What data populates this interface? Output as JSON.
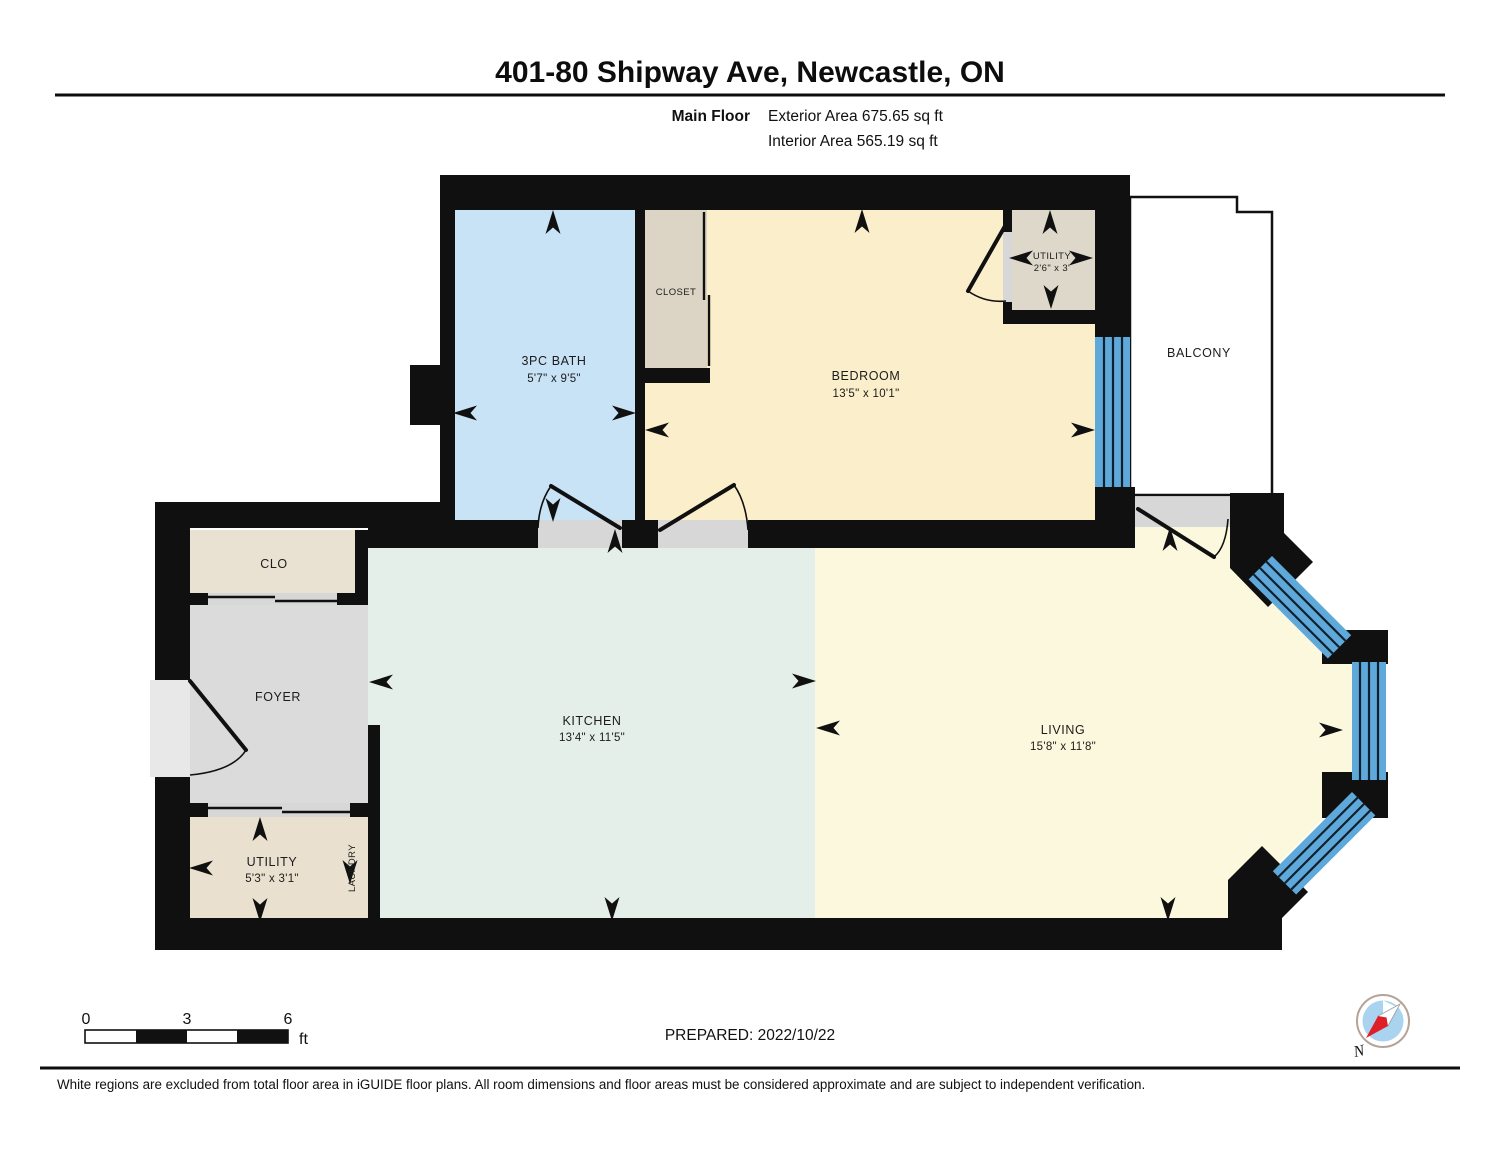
{
  "header": {
    "title": "401-80 Shipway Ave, Newcastle, ON",
    "floor_label": "Main Floor",
    "exterior_area": "Exterior Area 675.65 sq ft",
    "interior_area": "Interior Area 565.19 sq ft"
  },
  "rooms": {
    "bath": {
      "name": "3PC BATH",
      "dims": "5'7\" x 9'5\""
    },
    "closet": {
      "name": "CLOSET"
    },
    "bedroom": {
      "name": "BEDROOM",
      "dims": "13'5\" x 10'1\""
    },
    "utility_top": {
      "name": "UTILITY",
      "dims": "2'6\" x 3'"
    },
    "balcony": {
      "name": "BALCONY"
    },
    "clo": {
      "name": "CLO"
    },
    "foyer": {
      "name": "FOYER"
    },
    "utility_bottom": {
      "name": "UTILITY",
      "dims": "5'3\" x 3'1\""
    },
    "laundry": {
      "name": "LAUNDRY"
    },
    "kitchen": {
      "name": "KITCHEN",
      "dims": "13'4\" x 11'5\""
    },
    "living": {
      "name": "LIVING",
      "dims": "15'8\" x 11'8\""
    }
  },
  "scale_bar": {
    "start": "0",
    "mid": "3",
    "end": "6",
    "unit": "ft"
  },
  "compass": {
    "north_label": "N"
  },
  "footer": {
    "prepared": "PREPARED: 2022/10/22",
    "disclaimer": "White regions are excluded from total floor area in iGUIDE floor plans. All room dimensions and floor areas must be considered approximate and are subject to independent verification."
  },
  "colors": {
    "wall": "#101010",
    "bath": "#c8e2f6",
    "bedroom": "#fbeecb",
    "living": "#fcf8dd",
    "kitchen": "#e4efe9",
    "closet_top": "#dcd4c5",
    "utility_top": "#ded8cb",
    "clo": "#e9e1d1",
    "utility_bottom": "#e9e0cf",
    "foyer": "#dbdbdb",
    "threshold": "#d7d7d7",
    "window": "#5fa9da",
    "balcony": "#ffffff",
    "compass_red": "#dd2027",
    "compass_blue": "#a9d3ef"
  }
}
